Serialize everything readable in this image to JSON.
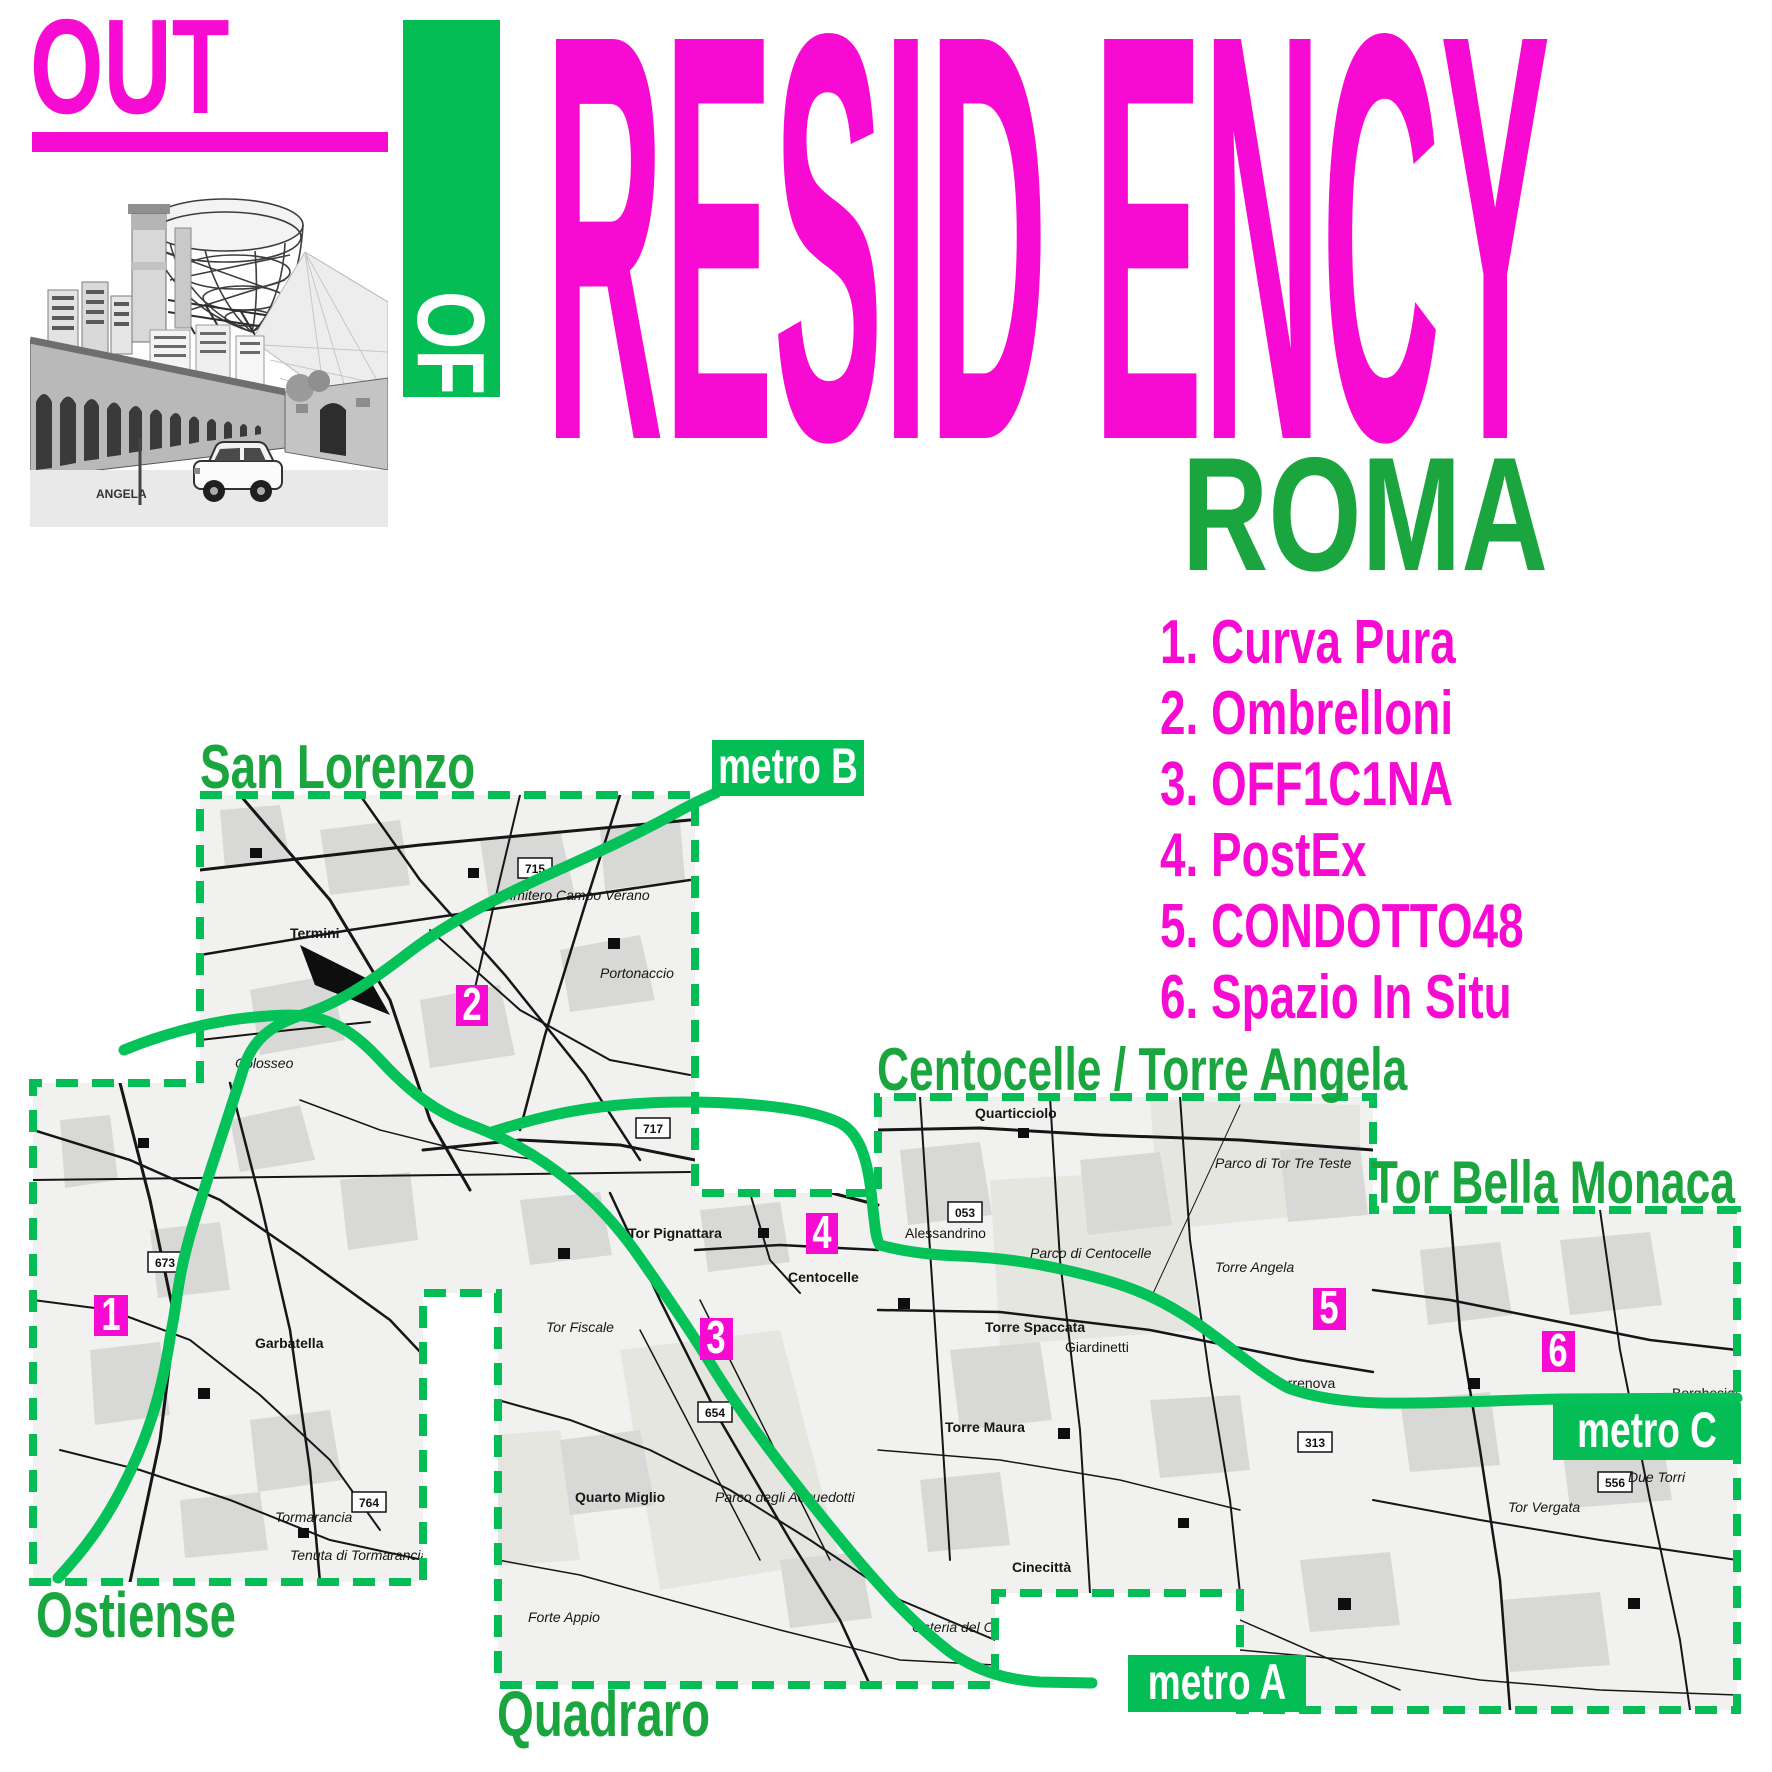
{
  "poster": {
    "title_top": "OUT",
    "title_of": "OF",
    "title_main": "RESID ENCY",
    "title_city": "ROMA",
    "photo_caption": "ANGELA"
  },
  "venues": [
    {
      "label": "1. Curva Pura"
    },
    {
      "label": "2. Ombrelloni"
    },
    {
      "label": "3. OFF1C1NA"
    },
    {
      "label": "4. PostEx"
    },
    {
      "label": "5. CONDOTTO48"
    },
    {
      "label": "6. Spazio In Situ"
    }
  ],
  "map": {
    "districts": [
      {
        "label": "San Lorenzo"
      },
      {
        "label": "Centocelle / Torre Angela"
      },
      {
        "label": "Tor Bella Monaca"
      },
      {
        "label": "Ostiense"
      },
      {
        "label": "Quadraro"
      }
    ],
    "metro_badges": [
      {
        "label": "metro B"
      },
      {
        "label": "metro A"
      },
      {
        "label": "metro C"
      }
    ],
    "markers": [
      {
        "num": "1"
      },
      {
        "num": "2"
      },
      {
        "num": "3"
      },
      {
        "num": "4"
      },
      {
        "num": "5"
      },
      {
        "num": "6"
      }
    ],
    "places": [
      {
        "label": "Termini"
      },
      {
        "label": "Colosseo"
      },
      {
        "label": "Cimitero Campo Verano"
      },
      {
        "label": "Portonaccio"
      },
      {
        "label": "Garbatella"
      },
      {
        "label": "Tormarancia"
      },
      {
        "label": "Tenuta di Tormarancia"
      },
      {
        "label": "Tor Pignattara"
      },
      {
        "label": "Parco di Centocelle"
      },
      {
        "label": "Centocelle"
      },
      {
        "label": "Quarticciolo"
      },
      {
        "label": "Parco di Tor Tre Teste"
      },
      {
        "label": "Alessandrino"
      },
      {
        "label": "Torre Spaccata"
      },
      {
        "label": "Torre Maura"
      },
      {
        "label": "Torre Angela"
      },
      {
        "label": "Torrenova"
      },
      {
        "label": "Giardinetti"
      },
      {
        "label": "Tor Vergata"
      },
      {
        "label": "Due Torri"
      },
      {
        "label": "Tor Fiscale"
      },
      {
        "label": "Quarto Miglio"
      },
      {
        "label": "Forte Appio"
      },
      {
        "label": "Parco degli Acquedotti"
      },
      {
        "label": "Osteria del Curato"
      },
      {
        "label": "Cinecittà"
      },
      {
        "label": "Borghesiana"
      }
    ],
    "route_badges": [
      "715",
      "717",
      "673",
      "764",
      "654",
      "053",
      "313",
      "556"
    ]
  },
  "colors": {
    "magenta": "#f70ad2",
    "green_bright": "#04bd55",
    "green_text": "#1aa53e"
  }
}
